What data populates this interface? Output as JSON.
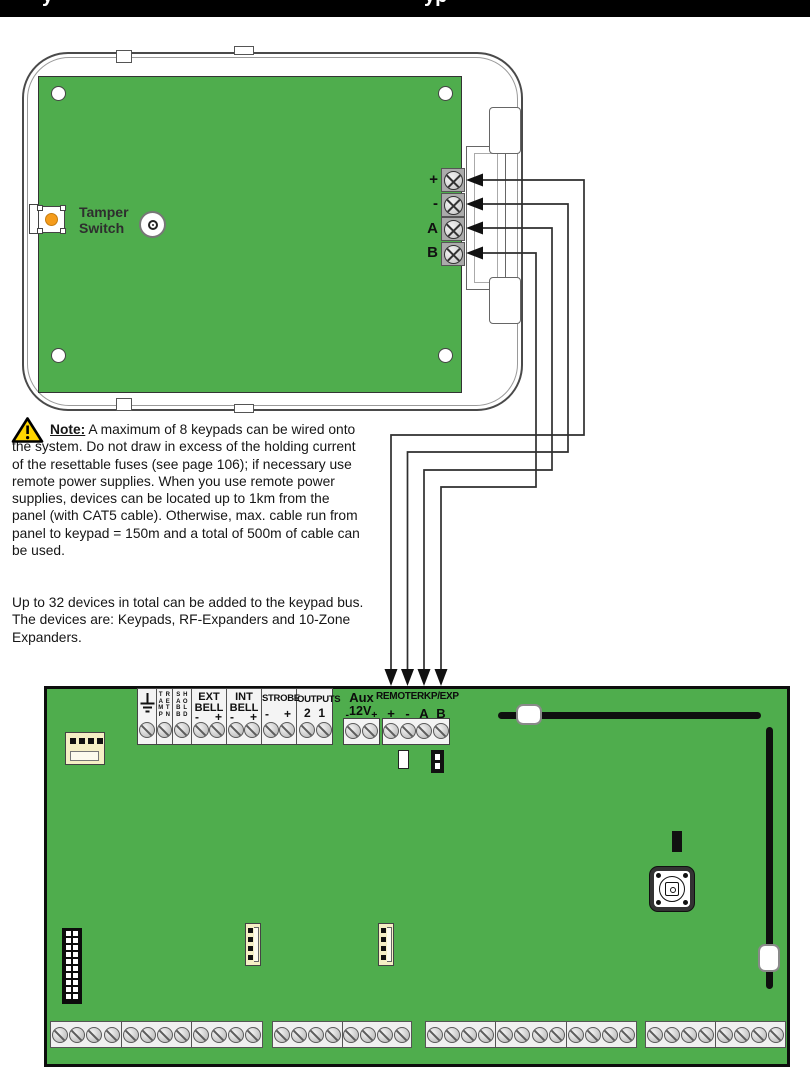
{
  "title_bar": {
    "fragment_left": "y",
    "fragment_right": "yp",
    "bar_color": "#000000"
  },
  "keypad": {
    "tamper_label_line1": "Tamper",
    "tamper_label_line2": "Switch",
    "terminal_labels": [
      "+",
      "-",
      "A",
      "B"
    ]
  },
  "note": {
    "label": "Note:",
    "paragraph1_rest": " A maximum of 8 keypads can be wired onto the system. Do not draw in excess of the holding current of the resettable fuses (see page 106); if necessary use remote power supplies. When you use remote power supplies, devices can be located up to 1km from the panel (with CAT5 cable). Otherwise, max. cable run from panel to keypad = 150m and a total of 500m of cable can be used.",
    "paragraph2": "Up to 32 devices in total can be added to the keypad bus. The devices are: Keypads, RF-Expanders and 10-Zone Expanders."
  },
  "panel": {
    "vertical_labels": [
      "TAMP",
      "RETN",
      "SABB",
      "HOLD"
    ],
    "ext_bell": {
      "line1": "EXT",
      "line2": "BELL",
      "neg": "-",
      "pos": "+"
    },
    "int_bell": {
      "line1": "INT",
      "line2": "BELL",
      "neg": "-",
      "pos": "+"
    },
    "strobe": {
      "label": "STROBE",
      "neg": "-",
      "pos": "+"
    },
    "outputs": {
      "label": "OUTPUTS",
      "t2": "2",
      "t1": "1"
    },
    "aux": {
      "label": "Aux",
      "voltage": "12V",
      "neg": "-",
      "pos": "+"
    },
    "remote": {
      "label": "REMOTE",
      "pos": "+",
      "neg": "-"
    },
    "rkp_exp": {
      "label": "RKP/EXP",
      "a": "A",
      "b": "B"
    }
  },
  "wiring": {
    "keypad_terminals": [
      "+",
      "-",
      "A",
      "B"
    ],
    "panel_terminals": [
      "REMOTE +",
      "REMOTE -",
      "RKP/EXP A",
      "RKP/EXP B"
    ]
  },
  "icons": {
    "warning": "yellow triangle with exclamation mark",
    "earth": "earth-ground symbol",
    "panel_screw": "slotted screw head",
    "keypad_screw": "cross screw head"
  },
  "colors": {
    "pcb_green": "#4FAD4D",
    "title_bar_black": "#000000",
    "connector_cream": "#F5EFC5",
    "tamper_button_orange": "#F59C1B",
    "warning_yellow": "#FFD500",
    "wire_gray": "#2F2F2F"
  }
}
